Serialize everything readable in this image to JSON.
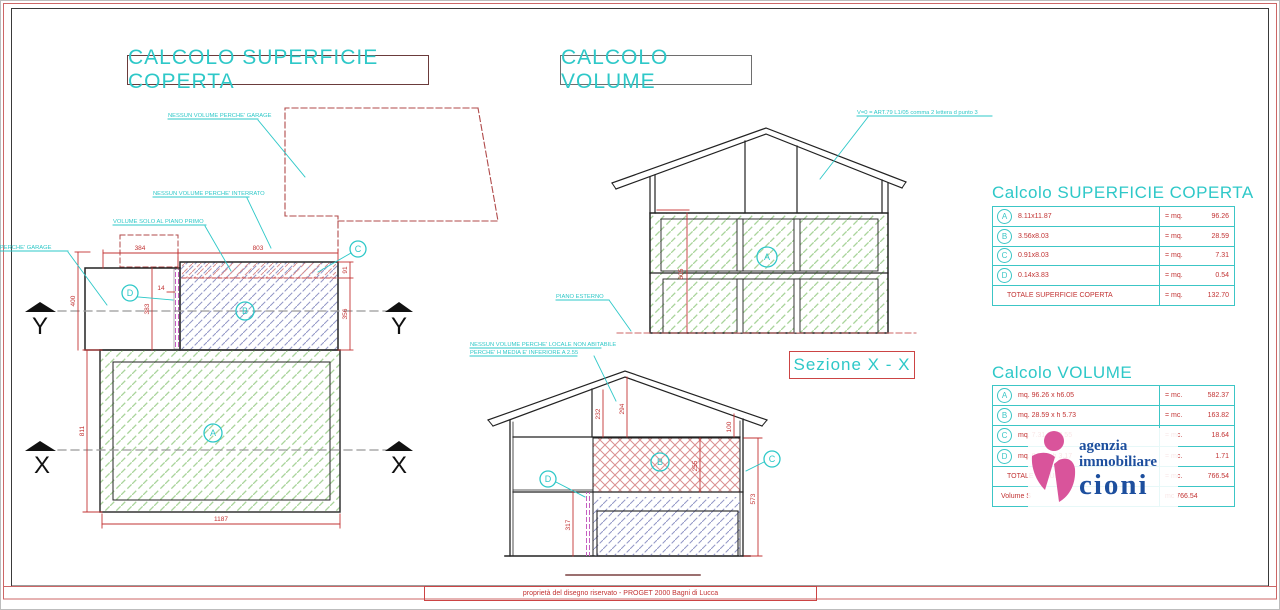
{
  "titles": {
    "superficie": "CALCOLO SUPERFICIE COPERTA",
    "volume": "CALCOLO VOLUME",
    "sezione_xx": "Sezione X - X"
  },
  "plan": {
    "notes": {
      "garage": "NESSUN VOLUME PERCHE' GARAGE",
      "garage_left": "NESSUN VOLUME PERCHE' GARAGE",
      "interrato": "NESSUN VOLUME PERCHE' INTERRATO",
      "piano_primo": "VOLUME SOLO AL PIANO PRIMO"
    },
    "dims": {
      "top_left": "384",
      "top_right": "803",
      "strip": "91",
      "first_floor": "356",
      "left_outer": "400",
      "garage_height": "383",
      "d_width": "14",
      "ground_height": "811",
      "ground_width": "1187"
    },
    "areas": {
      "a": "A",
      "b": "B",
      "c": "C",
      "d": "D"
    },
    "axes": {
      "x": "X",
      "y": "Y"
    }
  },
  "section_xx": {
    "v0_note": "V=0 = ART.79 L1/05 comma 2 lettera d punto 3",
    "piano_esterno": "PIANO ESTERNO",
    "dims": {
      "height": "605"
    },
    "areas": {
      "a": "A"
    }
  },
  "section_yy": {
    "note_line1": "NESSUN VOLUME PERCHE' LOCALE NON ABITABILE",
    "note_line2": "PERCHE' H MEDIA E' INFERIORE A 2.55",
    "dims": {
      "attic_left": "232",
      "attic_ridge": "294",
      "attic_right": "100",
      "first_floor": "255",
      "right_total": "573",
      "ground_left": "317"
    },
    "areas": {
      "b": "B",
      "c": "C",
      "d": "D"
    }
  },
  "tables": {
    "superficie": {
      "title": "Calcolo SUPERFICIE COPERTA",
      "rows": [
        {
          "mark": "A",
          "formula": "8.11x11.87",
          "unit": "= mq.",
          "value": "96.26"
        },
        {
          "mark": "B",
          "formula": "3.56x8.03",
          "unit": "= mq.",
          "value": "28.59"
        },
        {
          "mark": "C",
          "formula": "0.91x8.03",
          "unit": "= mq.",
          "value": "7.31"
        },
        {
          "mark": "D",
          "formula": "0.14x3.83",
          "unit": "= mq.",
          "value": "0.54"
        }
      ],
      "total_label": "TOTALE SUPERFICIE COPERTA",
      "total_unit": "= mq.",
      "total_value": "132.70"
    },
    "volume": {
      "title": "Calcolo VOLUME",
      "rows": [
        {
          "mark": "A",
          "formula": "mq. 96.26 x h6.05",
          "unit": "= mc.",
          "value": "582.37"
        },
        {
          "mark": "B",
          "formula": "mq. 28.59 x h 5.73",
          "unit": "= mc.",
          "value": "163.82"
        },
        {
          "mark": "C",
          "formula": "mq. 7.31 x h 2.55",
          "unit": "= mc.",
          "value": "18.64"
        },
        {
          "mark": "D",
          "formula": "mq. 0.54 x h 3.17",
          "unit": "= mc.",
          "value": "1.71"
        }
      ],
      "total_label": "TOTALE VOLUME",
      "total_unit": "= mc.",
      "total_value": "766.54",
      "note_left": "Volume S",
      "note_right": "mc 766.54"
    }
  },
  "logo": {
    "line1": "agenzia",
    "line2": "immobiliare",
    "line3": "cioni"
  },
  "footer": {
    "text": "proprietà del disegno riservato - PROGET 2000 Bagni di Lucca"
  }
}
